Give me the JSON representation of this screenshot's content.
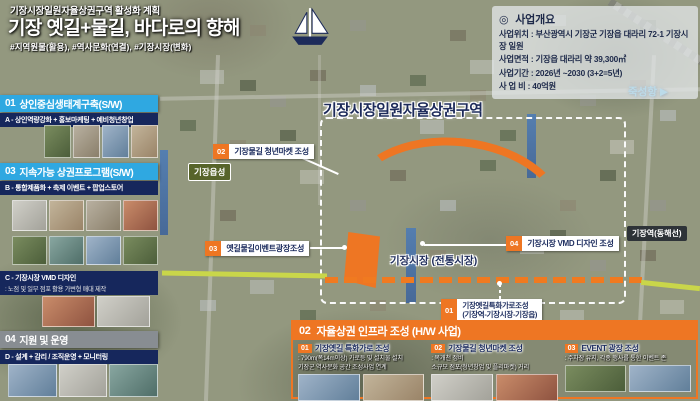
{
  "colors": {
    "accent_orange": "#ee7623",
    "header_blue": "#2fa8e1",
    "navy": "#16275c",
    "line_yellow": "#c9d64a",
    "water_blue": "#3e6db0"
  },
  "header": {
    "supertitle": "기장시장일원자율상권구역 활성화 계획",
    "title": "기장 옛길+물길, 바다로의 향해",
    "hashtags": "#지역원물(활용), #역사문화(연결), #기장시장(변화)"
  },
  "overview": {
    "bullet": "◎",
    "title": "사업개요",
    "rows": [
      "사업위치 : 부산광역시 기장군 기장읍 대라리 72-1 기장시장 일원",
      "사업면적 : 기장읍 대라리 약 39,300㎡",
      "사업기간 : 2026년 ~2030 (3+2=5년)",
      "사 업 비 : 40억원"
    ]
  },
  "sidebar": {
    "section1": {
      "num": "01",
      "title": "상인중심생태계구축(S/W)",
      "band": "A - 상인역량강화 + 홍보마케팅 + 예비청년창업"
    },
    "section3": {
      "num": "03",
      "title": "지속가능 상권프로그램(S/W)",
      "band_b": "B - 통합제품화 + 축제 이벤트 + 팝업스토어",
      "band_c": "C - 기장시장 VMD 디자인",
      "band_c_sub": ": 노점 및 일부 점포 활용 가변형 매대 제작"
    },
    "section4": {
      "num": "04",
      "title": "지원 및 운영",
      "band": "D - 설계 + 감리 / 조직운영 + 모니터링"
    }
  },
  "map": {
    "district_title": "기장시장일원자율상권구역",
    "market_label": "기장시장 (전통시장)",
    "places": {
      "eupseong": "기장읍성",
      "station": "기장역(동해선)",
      "port": "죽성항",
      "port_arrow": "▶"
    },
    "callouts": {
      "c02": {
        "num": "02",
        "label": "기장물길 청년마켓 조성"
      },
      "c03": {
        "num": "03",
        "label": "옛길물길이벤트광장조성"
      },
      "c04": {
        "num": "04",
        "label": "기장시장 VMD 디자인 조성"
      },
      "c01": {
        "num": "01",
        "label": "기장옛길특화가로조성",
        "label2": "(기장역-기장시장-기장읍)"
      }
    }
  },
  "infra_panel": {
    "num": "02",
    "title": "자율상권 인프라 조성 (H/W 사업)",
    "items": [
      {
        "num": "01",
        "title": "기장옛길 특화가로 조성",
        "line1": ": 790m(폭14m이상) 가로등 및 설치물 설치",
        "line2": "기장군 역사문화 공간 조성사업 연계"
      },
      {
        "num": "02",
        "title": "기장물길 청년마켓 조성",
        "line1": ": 복개천 정비",
        "line2": "소규모 점포(청년창업 및 플리마켓) 거리"
      },
      {
        "num": "03",
        "title": "EVENT 광장 조성",
        "line1": ": 주차장 유지, 각종 행사를 통한 이벤트 존",
        "line2": ""
      }
    ]
  }
}
